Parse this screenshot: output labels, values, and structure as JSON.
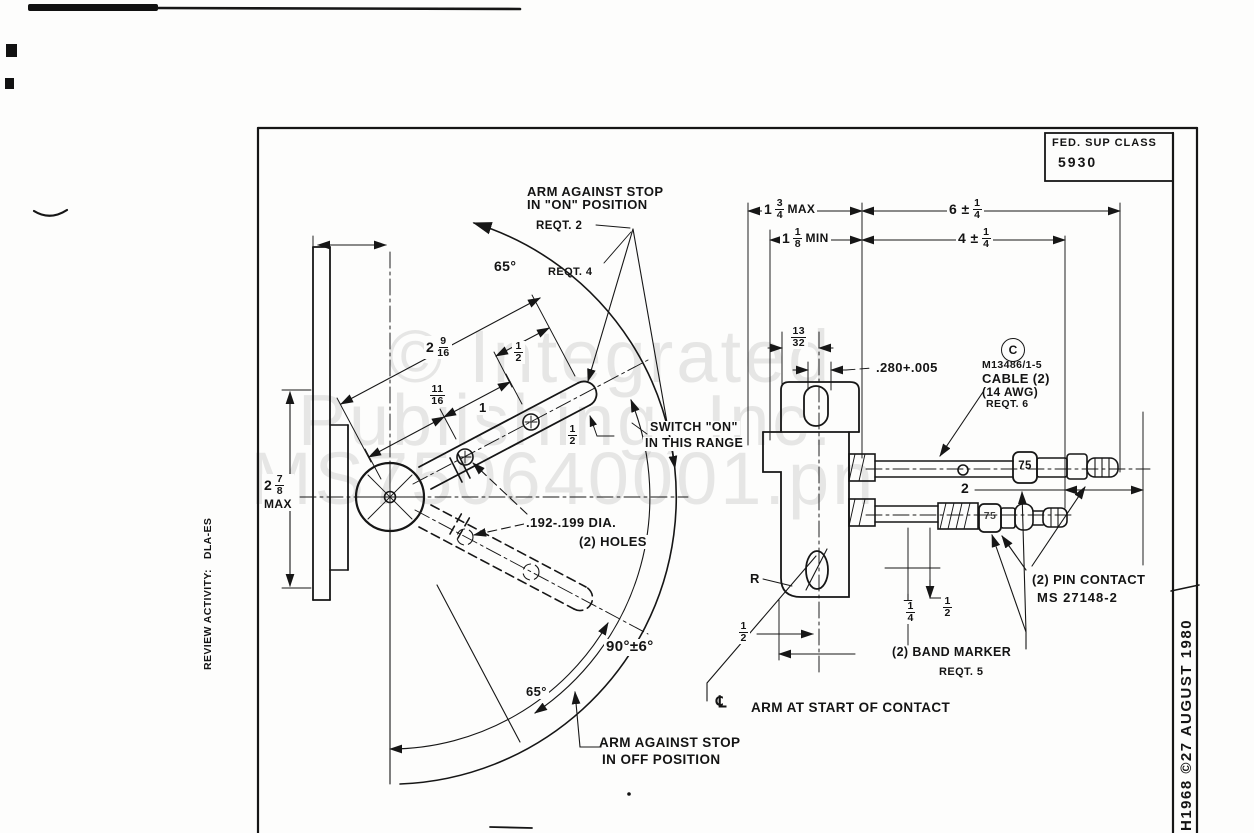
{
  "title_block": {
    "fed_sup_class_label": "FED. SUP CLASS",
    "fed_sup_class_value": "5930"
  },
  "margins": {
    "review_activity": "REVIEW ACTIVITY:   DLA-ES",
    "date_stamp": "H1968 ©27 AUGUST 1980"
  },
  "watermark": {
    "line1": "© Integrated",
    "line2": "Publishing, Inc.",
    "line3": "MS750640001.pn"
  },
  "callouts": {
    "arm_on_line1": "ARM AGAINST STOP",
    "arm_on_line2": "IN \"ON\" POSITION",
    "reqt2": "REQT. 2",
    "reqt4": "REQT. 4",
    "angle65_top": "65°",
    "switch_on_line1": "SWITCH \"ON\"",
    "switch_on_line2": "IN THIS RANGE",
    "holes_line1": ".192-.199 DIA.",
    "holes_line2": "(2) HOLES",
    "circled_c": "C",
    "cable_line1": "M13486/1-5",
    "cable_line2": "CABLE (2)",
    "cable_line3": "(14 AWG)",
    "cable_line4": "REQT. 6",
    "pin_line1": "(2) PIN CONTACT",
    "pin_line2": "MS 27148-2",
    "band_line1": "(2) BAND MARKER",
    "band_line2": "REQT. 5",
    "angle90": "90°±6°",
    "angle65_bottom": "65°",
    "centerline_symbol": "℄",
    "arm_contact": "ARM AT START OF CONTACT",
    "arm_off_line1": "ARM AGAINST STOP",
    "arm_off_line2": "IN OFF POSITION",
    "r_label": "R",
    "band75_top": "75",
    "band75_bottom": "75"
  },
  "dims": {
    "max134": {
      "whole": "1",
      "num": "3",
      "den": "4",
      "suffix": "MAX"
    },
    "plus614": {
      "prefix": "6 ±",
      "num": "1",
      "den": "4"
    },
    "min118": {
      "whole": "1",
      "num": "1",
      "den": "8",
      "suffix": "MIN"
    },
    "plus414": {
      "prefix": "4 ±",
      "num": "1",
      "den": "4"
    },
    "f1332": {
      "num": "13",
      "den": "32"
    },
    "slot280": ".280+.005",
    "f2916": {
      "whole": "2",
      "num": "9",
      "den": "16"
    },
    "f12a": {
      "num": "1",
      "den": "2"
    },
    "f1116": {
      "num": "11",
      "den": "16"
    },
    "one_a": "1",
    "f12b": {
      "num": "1",
      "den": "2"
    },
    "max278": {
      "whole": "2",
      "num": "7",
      "den": "8",
      "suffix": "MAX"
    },
    "two": "2",
    "f14": {
      "num": "1",
      "den": "4"
    },
    "f12c": {
      "num": "1",
      "den": "2"
    },
    "f12d": {
      "num": "1",
      "den": "2"
    }
  }
}
